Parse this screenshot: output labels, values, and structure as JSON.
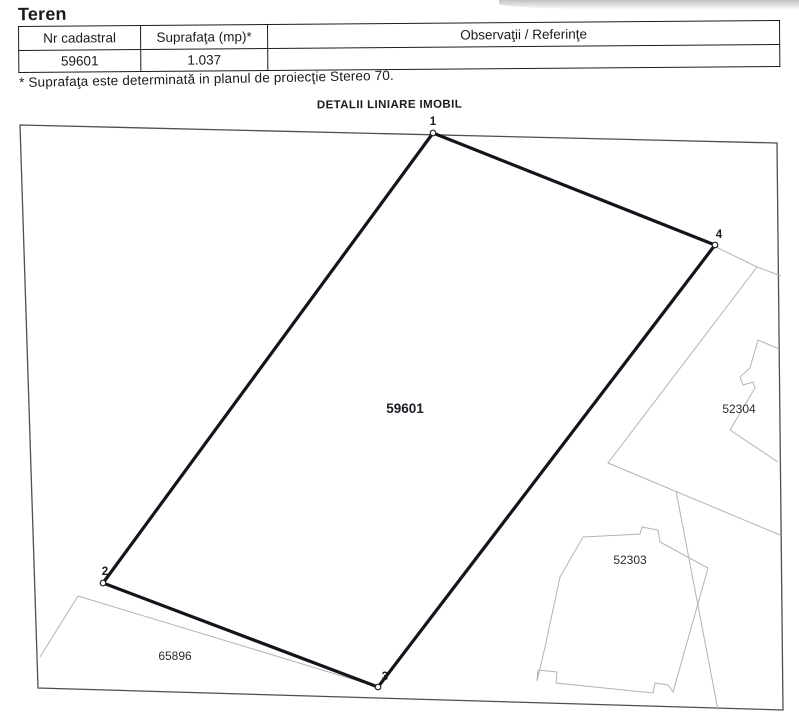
{
  "page": {
    "title": "Teren"
  },
  "table": {
    "headers": [
      "Nr cadastral",
      "Suprafaţa (mp)*",
      "Observaţii / Referinţe"
    ],
    "row": {
      "nr_cadastral": "59601",
      "suprafata": "1.037",
      "observatii": ""
    }
  },
  "note": "* Suprafaţa este determinată in planul de proiecţie Stereo 70.",
  "map": {
    "heading": "DETALII LINIARE IMOBIL",
    "colors": {
      "frame": "#4f4f4f",
      "parcel_outline": "#14141b",
      "faint_line": "#b3b3b3",
      "label": "#2b2b2b"
    },
    "frame_points": "20,125 777,143 783,710 38,688",
    "main_parcel": {
      "label": "59601",
      "label_x": 405,
      "label_y": 413,
      "points": "433,133 715,245 378,687 103,583",
      "stroke_width": 3.2,
      "vertices": [
        {
          "n": "1",
          "cx": 433,
          "cy": 133,
          "lx": 433,
          "ly": 125
        },
        {
          "n": "4",
          "cx": 715,
          "cy": 245,
          "lx": 719,
          "ly": 238
        },
        {
          "n": "3",
          "cx": 378,
          "cy": 687,
          "lx": 385,
          "ly": 680
        },
        {
          "n": "2",
          "cx": 103,
          "cy": 583,
          "lx": 105,
          "ly": 575
        }
      ]
    },
    "faint_lines": [
      "716,247 757,267 781,276",
      "757,267 608,463 780,535",
      "676,491 718,710",
      "78,596 40,657",
      "78,596 375,686",
      "779,349 758,340 750,368 740,377 743,385 753,382 755,388 730,430 778,462",
      "583,537 640,534 642,527 658,530 660,542 708,568 673,692 668,685 655,683 653,693 556,683 557,672 538,670 537,681 545,647 560,577 583,537"
    ],
    "neighbor_labels": [
      {
        "text": "52304",
        "x": 739,
        "y": 413
      },
      {
        "text": "52303",
        "x": 630,
        "y": 564
      },
      {
        "text": "65896",
        "x": 175,
        "y": 660
      }
    ]
  }
}
